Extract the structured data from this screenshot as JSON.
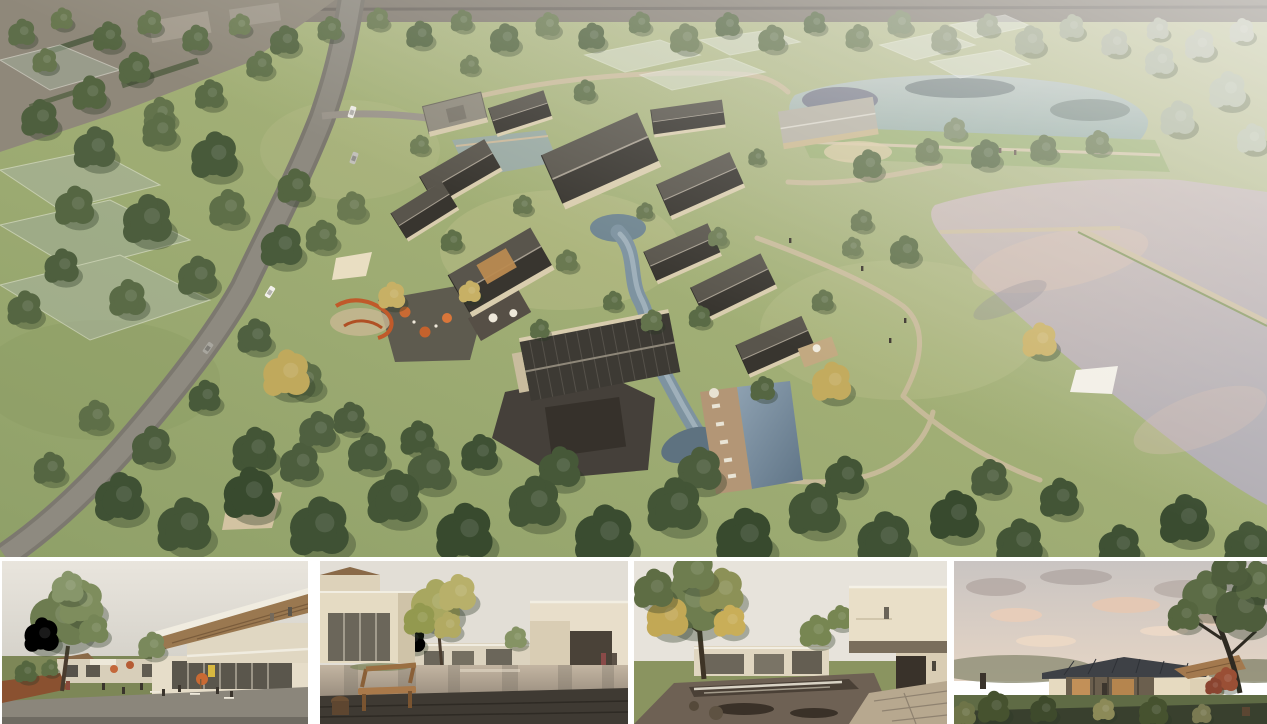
{
  "page": {
    "background": "#ffffff",
    "kind": "architectural rendering collage"
  },
  "collage": {
    "main": {
      "name": "aerial-site-overview",
      "description": "Aerial rendering of a courtyard village resort: clusters of houses with dark gabled roofs and cream walls around a winding blue-grey stream and swimming pool, a curving grey road with cars on the left, translucent existing sheds far left, orange playground and cafe umbrellas, two large reflective ponds separated by grass levees on the right, dense forest band along the bottom, hazy washed-out fields at the top right",
      "palette": {
        "grass": "#a3b077",
        "grass_pale": "#c3c4a0",
        "forest_dark": "#3f5134",
        "tree_mid": "#5c6d47",
        "tree_golden": "#c3ab5e",
        "roof_dark": "#38352f",
        "roof_light_side": "#59554c",
        "wall_beige": "#d9cdae",
        "road_grey": "#7c786f",
        "upper_pond_teal": "#9db3a9",
        "lower_pond_pink_grey": "#c4b8b2",
        "stream_blue_grey": "#7e93a0",
        "path_tan": "#c9bb9b",
        "accent_orange": "#c4622d",
        "stone_terrace": "#45403a"
      }
    },
    "thumbnails": [
      {
        "name": "plaza-view",
        "description": "Street-level view of a plaza: large green tree at left, lawn and corten planter, people at cafe tables with orange umbrellas, two-storey cream building at right with slanted timber-soffit roof and glass front"
      },
      {
        "name": "courtyard-pond-view",
        "description": "Courtyard with a reflecting pond between cream buildings, tall yellow-green tree, wooden bench and stump stool on a dark stone deck in the foreground, two people walking at right"
      },
      {
        "name": "waterfall-courtyard-view",
        "description": "Autumn courtyard: large tree with golden foliage at left, low glass buildings behind a lawn, pond with a small waterfall weir, cantilevered cream volume at right with a figure on the balcony, stone path in the foreground"
      },
      {
        "name": "dusk-pavilion-view",
        "description": "Single-storey glass pavilion with a dark standing-seam roof and timber wing on a lawn at dusk, pink-lit clouds, large tree at right, dark shrubs and grasses in the foreground"
      }
    ]
  }
}
